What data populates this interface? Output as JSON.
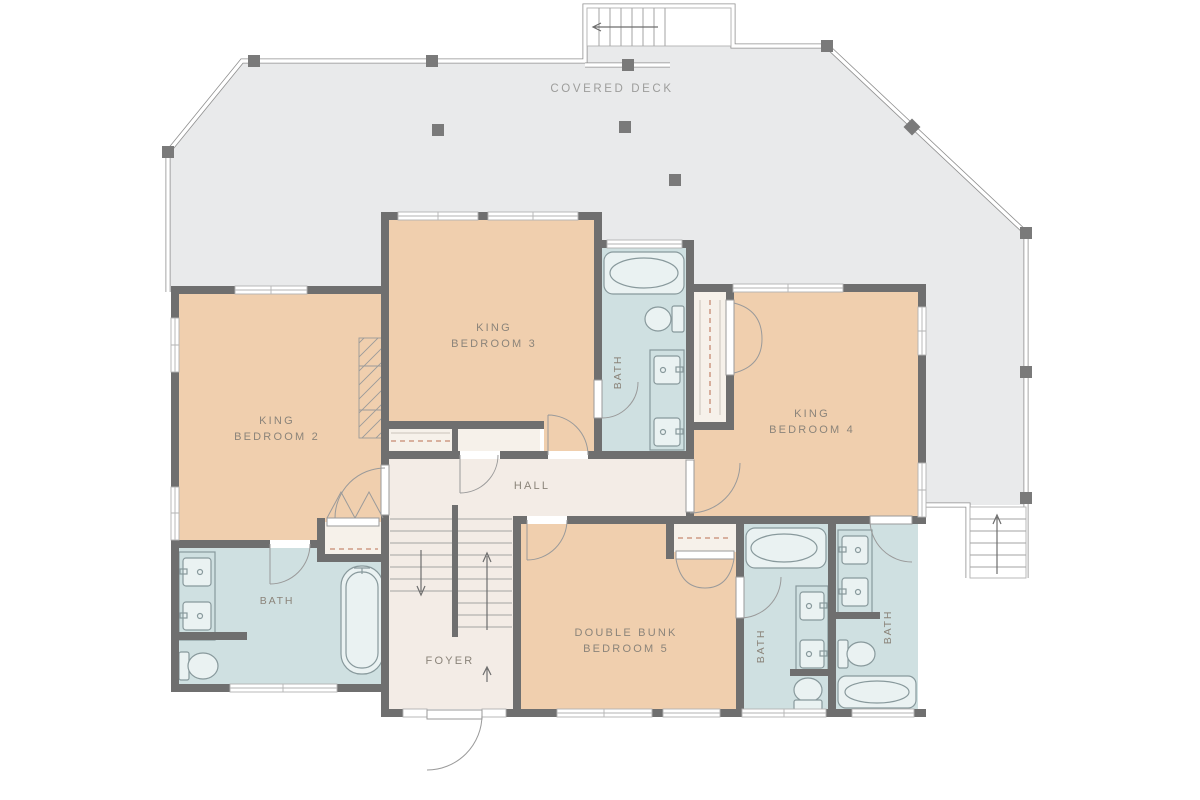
{
  "rooms": {
    "deck": {
      "label": "COVERED DECK"
    },
    "bedroom2": {
      "line1": "KING",
      "line2": "BEDROOM 2"
    },
    "bedroom3": {
      "line1": "KING",
      "line2": "BEDROOM 3"
    },
    "bedroom4": {
      "line1": "KING",
      "line2": "BEDROOM 4"
    },
    "bedroom5": {
      "line1": "DOUBLE BUNK",
      "line2": "BEDROOM 5"
    },
    "hall": {
      "label": "HALL"
    },
    "foyer": {
      "label": "FOYER"
    },
    "bath_bedroom2": {
      "label": "BATH"
    },
    "bath_bedroom3": {
      "label": "BATH"
    },
    "bath_bedroom5": {
      "label": "BATH"
    },
    "bath_bedroom4": {
      "label": "BATH"
    }
  },
  "colors": {
    "wall": "#6f6f6f",
    "bedroom": "#f0cfae",
    "bath": "#cfe0e1",
    "hall": "#f3ece6",
    "closet": "#f6f1ea",
    "deck": "#e9eaeb",
    "railing": "#8f8f8f",
    "post": "#7a7a7a",
    "label": "#8b847a",
    "deck_label": "#9d9d9b",
    "dash": "#c68a72",
    "fixture_stroke": "#88999c",
    "fixture_fill": "#eaf2f2",
    "door": "#9a9a9a",
    "tread": "#a3a3a3",
    "win_frame": "#b3b3b3",
    "hatch": "#9a9a9a"
  }
}
